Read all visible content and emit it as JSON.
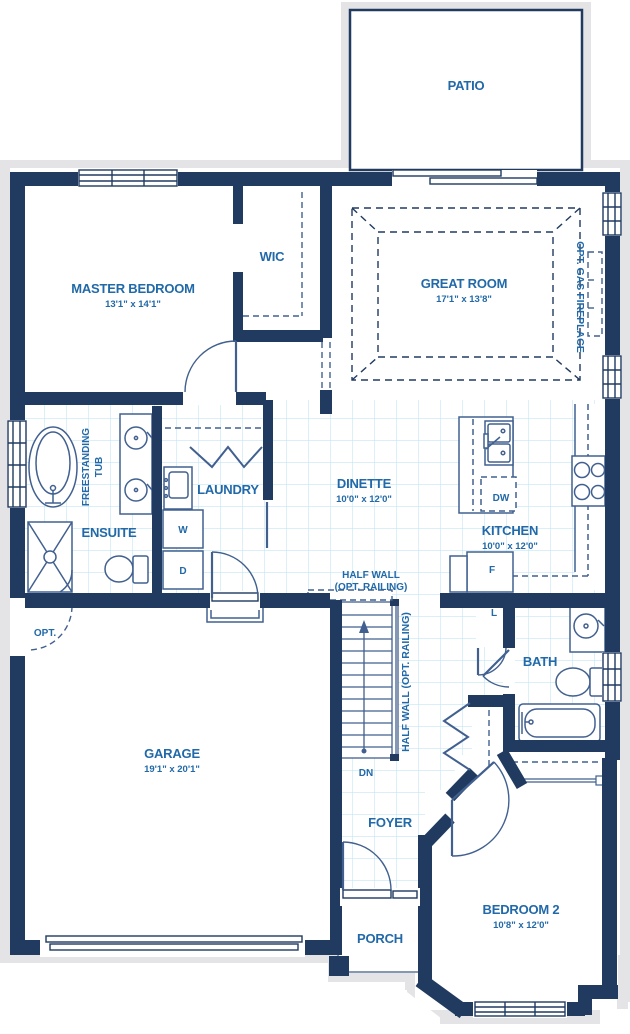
{
  "rooms": {
    "patio": "PATIO",
    "master_bedroom": "MASTER BEDROOM",
    "master_bedroom_dims": "13'1\" x 14'1\"",
    "wic": "WIC",
    "great_room": "GREAT ROOM",
    "great_room_dims": "17'1\" x 13'8\"",
    "opt_gas_fireplace": "OPT. GAS FIREPLACE",
    "freestanding_tub_line1": "FREESTANDING",
    "freestanding_tub_line2": "TUB",
    "ensuite": "ENSUITE",
    "laundry": "LAUNDRY",
    "washer": "W",
    "dryer": "D",
    "dinette": "DINETTE",
    "dinette_dims": "10'0\" x 12'0\"",
    "kitchen": "KITCHEN",
    "kitchen_dims": "10'0\" x 12'0\"",
    "dishwasher": "DW",
    "fridge": "F",
    "half_wall_line1": "HALF WALL",
    "half_wall_line2": "(OPT. RAILING)",
    "half_wall_vertical": "HALF WALL (OPT. RAILING)",
    "garage": "GARAGE",
    "garage_dims": "19'1\" x 20'1\"",
    "opt_door": "OPT.",
    "stairs_down": "DN",
    "linen": "L",
    "bath": "BATH",
    "foyer": "FOYER",
    "porch": "PORCH",
    "bedroom2": "BEDROOM 2",
    "bedroom2_dims": "10'8\" x 12'0\""
  },
  "colors": {
    "wall": "#203A60",
    "fixture": "#41608F",
    "label": "#2169A8",
    "tile": "#C3E6F5",
    "outer_outline": "#E4E4E7"
  }
}
